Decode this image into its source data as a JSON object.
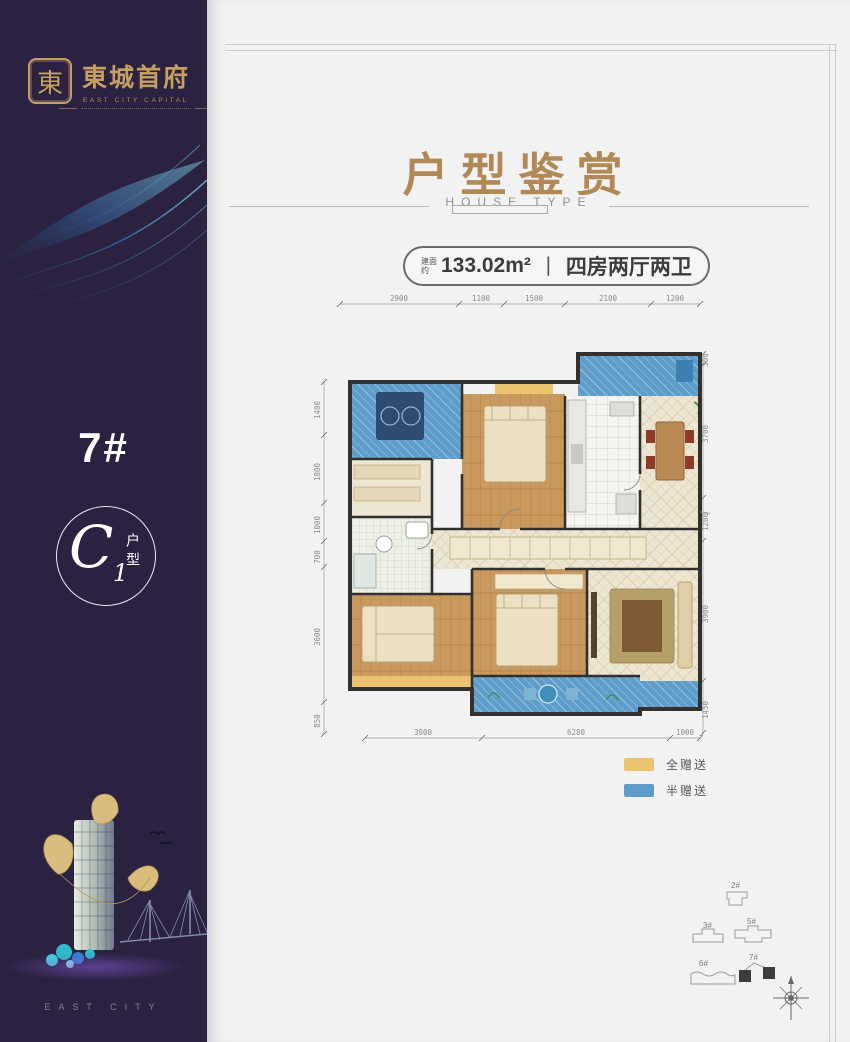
{
  "sidebar": {
    "logo": {
      "seal_char": "東",
      "brand": "東城首府",
      "brand_en": "EAST CITY CAPITAL"
    },
    "building_number": "7#",
    "unit": {
      "letter": "C",
      "number": "1",
      "suffix": "户型"
    },
    "footer_text": "EAST CITY"
  },
  "header": {
    "title": "户型鉴赏",
    "subtitle": "HOUSE TYPE"
  },
  "unit_info": {
    "area_prefix": "建面约",
    "area": "133.02m²",
    "separator": "丨",
    "layout": "四房两厅两卫"
  },
  "floorplan": {
    "dims_top": [
      "2900",
      "1100",
      "1500",
      "2100",
      "1200"
    ],
    "dims_left": [
      "1400",
      "1800",
      "1000",
      "700",
      "3600",
      "850"
    ],
    "dims_right": [
      "300",
      "3700",
      "1200",
      "3900",
      "1450"
    ],
    "dims_bottom": [
      "3900",
      "6280",
      "1000"
    ]
  },
  "legend": {
    "items": [
      {
        "label": "全赠送",
        "color": "#e9c36d"
      },
      {
        "label": "半赠送",
        "color": "#5e9dca"
      }
    ]
  },
  "siteplan": {
    "buildings": [
      {
        "label": "2#",
        "highlighted": false
      },
      {
        "label": "3#",
        "highlighted": false
      },
      {
        "label": "5#",
        "highlighted": false
      },
      {
        "label": "6#",
        "highlighted": false
      },
      {
        "label": "7#",
        "highlighted": true
      }
    ]
  },
  "colors": {
    "sidebar_bg": "#2a2240",
    "gold": "#c59e63",
    "title_gold": "#b08956",
    "content_bg": "#f2f2f3",
    "frame_line": "#c9c9ce",
    "text_dark": "#3c3c3c",
    "dim_text": "#8d8d8d",
    "full_gift": "#e9c36d",
    "half_gift": "#5e9dca",
    "wood": "#c9995d",
    "tile": "#ede6d2",
    "wall": "#33302d"
  }
}
